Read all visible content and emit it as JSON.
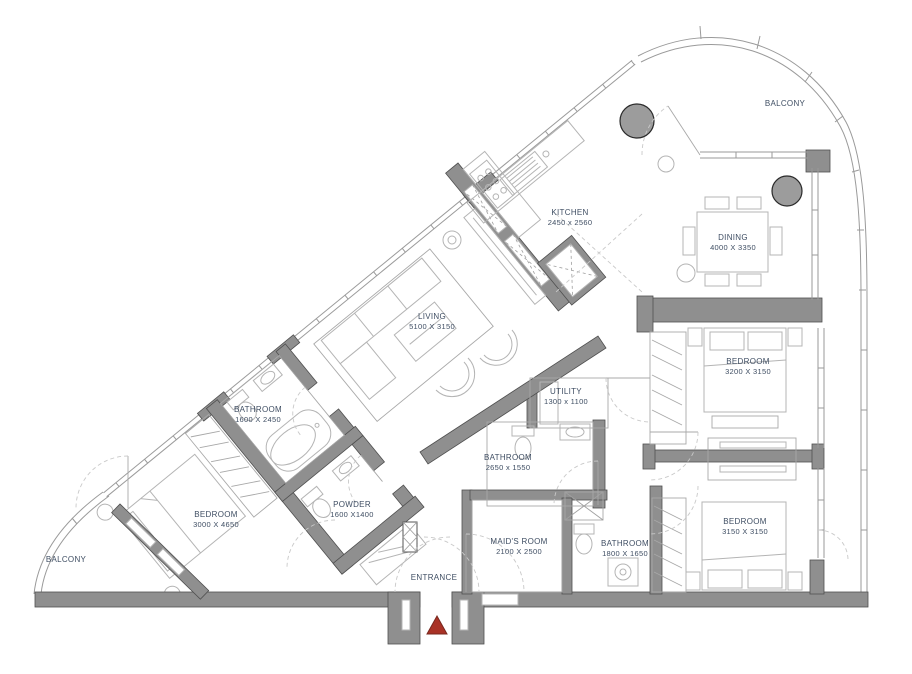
{
  "colors": {
    "wall": "#8f8f8f",
    "wall_stroke": "#4f4f4f",
    "furniture": "#b4b4b4",
    "window": "#9a9a9a",
    "label_text": "#3f4e63",
    "column": "#9c9c9c",
    "entrance_marker": "#a93226"
  },
  "rooms": {
    "balcony_top": {
      "name": "BALCONY"
    },
    "kitchen": {
      "name": "KITCHEN",
      "dims": "2450 x 2560"
    },
    "dining": {
      "name": "DINING",
      "dims": "4000 X 3350"
    },
    "living": {
      "name": "LIVING",
      "dims": "5100 X 3150"
    },
    "bedroom_top_right": {
      "name": "BEDROOM",
      "dims": "3200 X 3150"
    },
    "bedroom_bottom_right": {
      "name": "BEDROOM",
      "dims": "3150 X 3150"
    },
    "bedroom_left": {
      "name": "BEDROOM",
      "dims": "3000 X 4650"
    },
    "bathroom_left": {
      "name": "BATHROOM",
      "dims": "1600 X 2450"
    },
    "powder": {
      "name": "POWDER",
      "dims": "1600 X1400"
    },
    "utility": {
      "name": "UTILITY",
      "dims": "1300 x 1100"
    },
    "bathroom_middle": {
      "name": "BATHROOM",
      "dims": "2650 x 1550"
    },
    "maids_room": {
      "name": "MAID'S ROOM",
      "dims": "2100 X 2500"
    },
    "bathroom_right": {
      "name": "BATHROOM",
      "dims": "1800 X 1650"
    },
    "entrance": {
      "name": "ENTRANCE"
    },
    "balcony_bottom": {
      "name": "BALCONY"
    }
  }
}
